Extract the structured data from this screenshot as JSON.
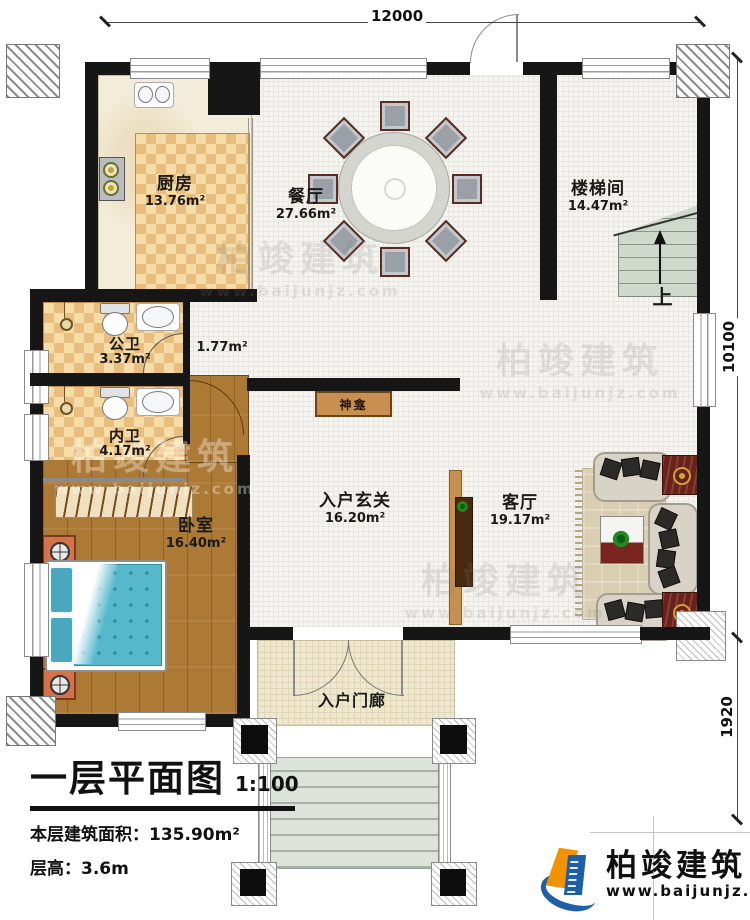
{
  "dimensions": {
    "top": "12000",
    "right_upper": "10100",
    "right_lower": "1920"
  },
  "rooms": {
    "kitchen": {
      "name": "厨房",
      "area": "13.76m²"
    },
    "dining": {
      "name": "餐厅",
      "area": "27.66m²"
    },
    "stairwell": {
      "name": "楼梯间",
      "area": "14.47m²"
    },
    "public_bath": {
      "name": "公卫",
      "area": "3.37m²"
    },
    "corridor": {
      "area": "1.77m²"
    },
    "private_bath": {
      "name": "内卫",
      "area": "4.17m²"
    },
    "bedroom": {
      "name": "卧室",
      "area": "16.40m²"
    },
    "foyer": {
      "name": "入户玄关",
      "area": "16.20m²"
    },
    "living": {
      "name": "客厅",
      "area": "19.17m²"
    },
    "porch": {
      "name": "入户门廊"
    },
    "shrine": {
      "name": "神龛"
    },
    "stairs": {
      "up_label": "上"
    }
  },
  "title_block": {
    "title": "一层平面图",
    "scale": "1:100",
    "floor_area": "本层建筑面积：135.90m²",
    "floor_height": "层高：3.6m"
  },
  "logo": {
    "name": "柏竣建筑",
    "url": "www.baijunjz.com"
  },
  "watermark": {
    "name": "柏竣建筑",
    "url": "www.baijunjz.com"
  },
  "colors": {
    "wall": "#161616",
    "checker_light": "#f6dda8",
    "checker_dark": "#e9bd7d",
    "wood": "#ad7a35",
    "bed": "#57b8cc",
    "accent_wood": "#c89050",
    "logo_blue": "#1f5fa8",
    "logo_orange": "#f29200"
  }
}
